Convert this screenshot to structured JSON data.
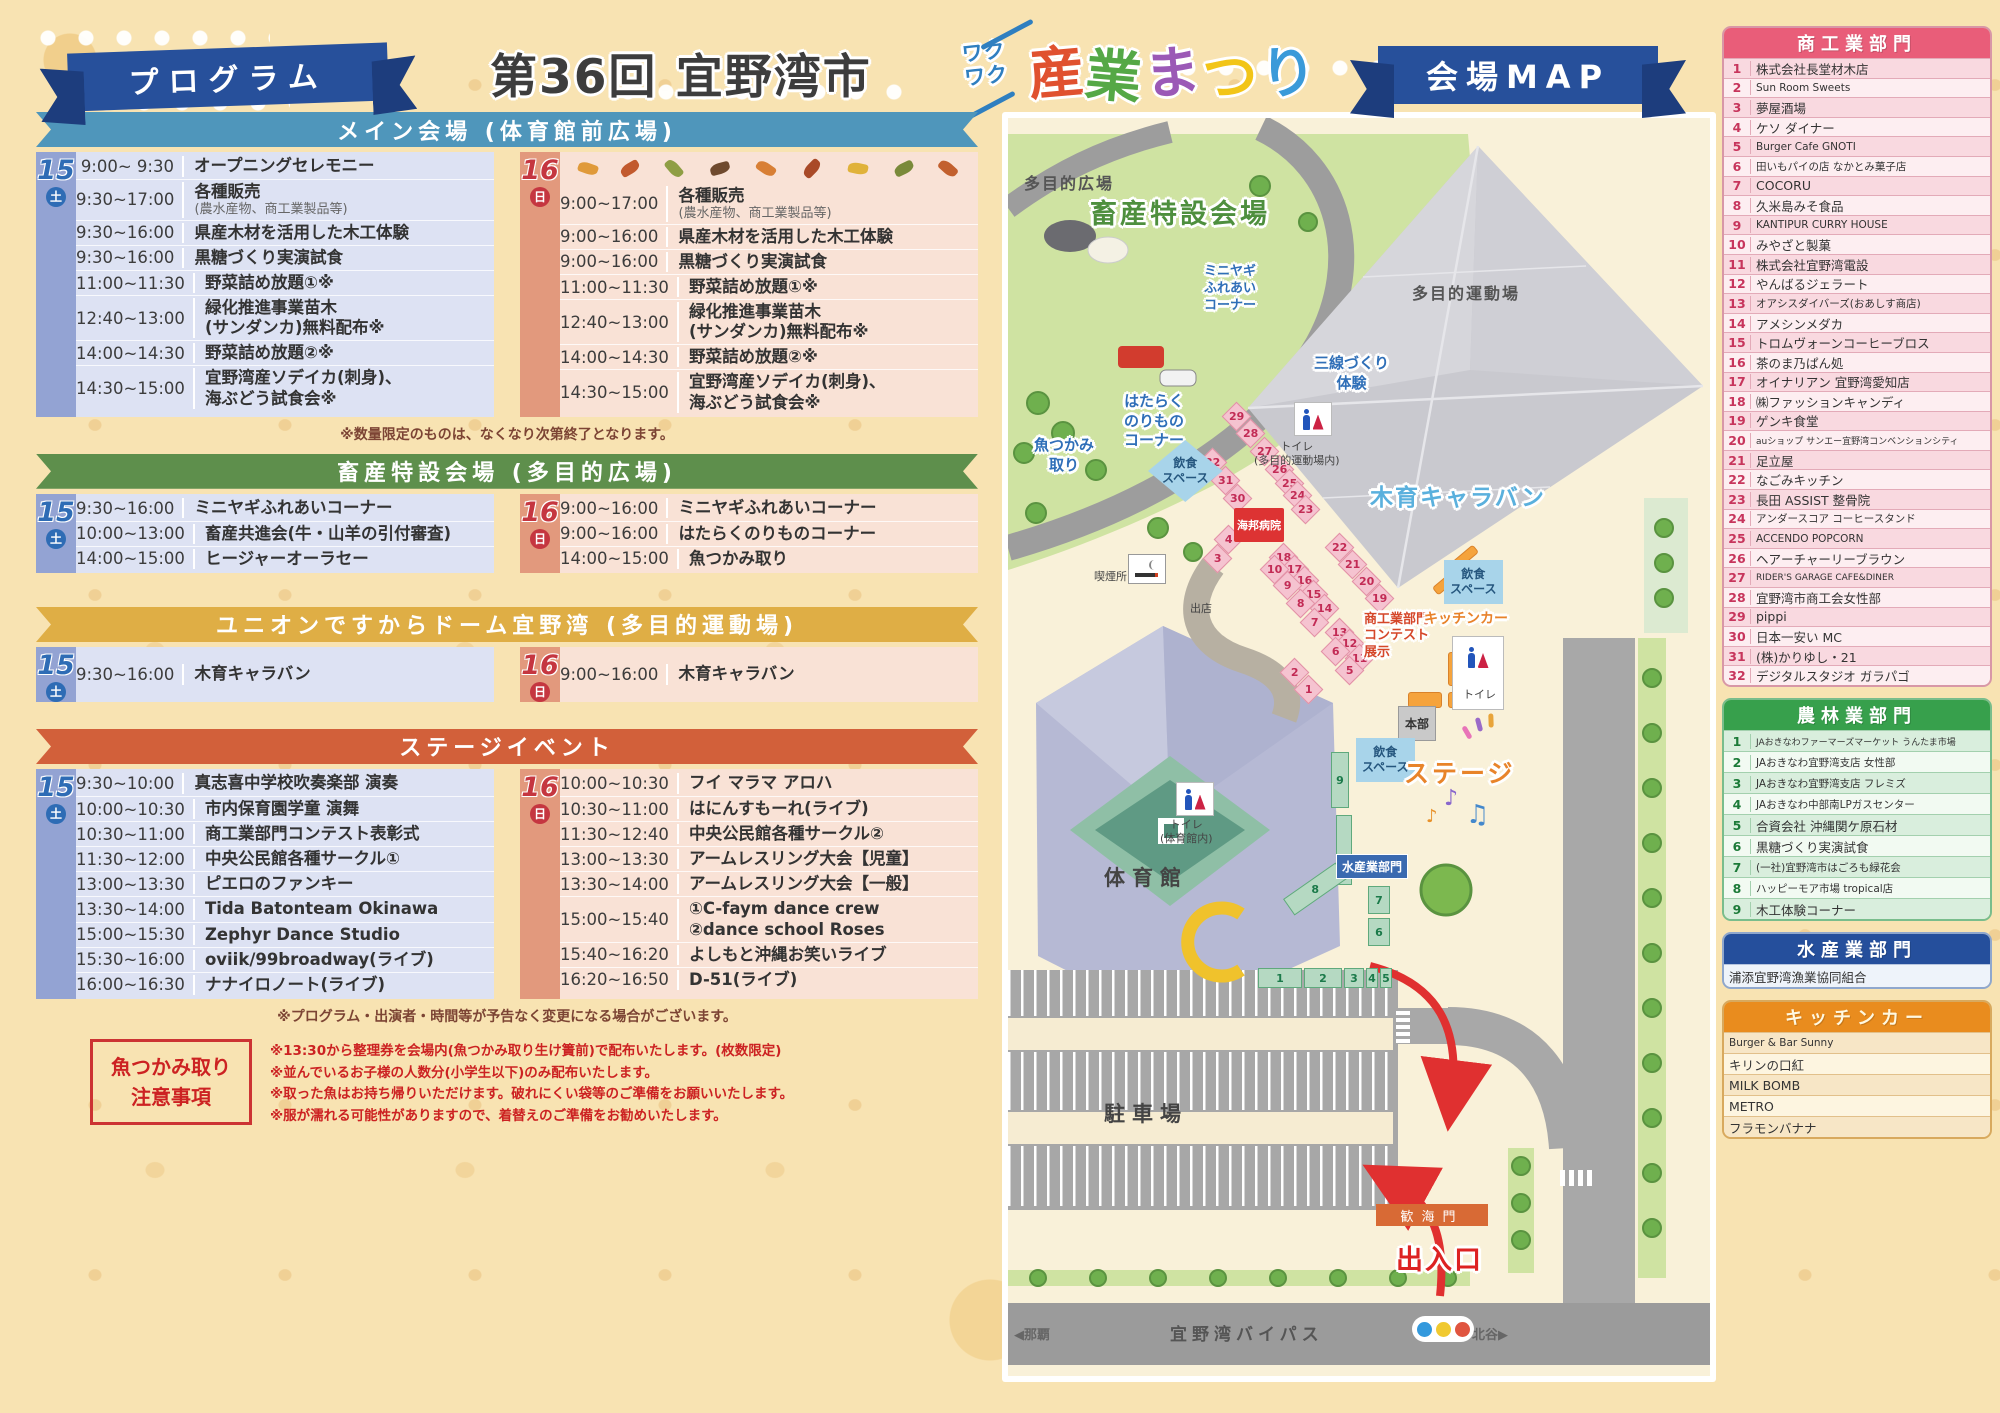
{
  "header": {
    "program_ribbon": "プログラム",
    "title_prefix": "第36回 宜野湾市",
    "title_waku": "ワクワク",
    "title_main": "産業まつり",
    "title_main_colors": [
      "#e0512f",
      "#55a846",
      "#9b59b6",
      "#f2c518",
      "#3a9ad9"
    ],
    "map_ribbon": "会場MAP"
  },
  "sections": [
    {
      "id": "main",
      "title": "メイン会場 (体育館前広場)",
      "accent": "#4f96bb",
      "sat": {
        "day": "15",
        "dow": "土",
        "rows": [
          {
            "time": "9:00~ 9:30",
            "event": "オープニングセレモニー"
          },
          {
            "time": "9:30~17:00",
            "event": "各種販売",
            "sub": "(農水産物、商工業製品等)"
          },
          {
            "time": "9:30~16:00",
            "event": "県産木材を活用した木工体験"
          },
          {
            "time": "9:30~16:00",
            "event": "黒糖づくり実演試食"
          },
          {
            "time": "11:00~11:30",
            "event": "野菜詰め放題①※"
          },
          {
            "time": "12:40~13:00",
            "event": "緑化推進事業苗木\n(サンダンカ)無料配布※"
          },
          {
            "time": "14:00~14:30",
            "event": "野菜詰め放題②※"
          },
          {
            "time": "14:30~15:00",
            "event": "宜野湾産ソデイカ(刺身)、\n海ぶどう試食会※"
          }
        ]
      },
      "sun": {
        "day": "16",
        "dow": "日",
        "leaves": true,
        "rows": [
          {
            "time": "9:00~17:00",
            "event": "各種販売",
            "sub": "(農水産物、商工業製品等)"
          },
          {
            "time": "9:00~16:00",
            "event": "県産木材を活用した木工体験"
          },
          {
            "time": "9:00~16:00",
            "event": "黒糖づくり実演試食"
          },
          {
            "time": "11:00~11:30",
            "event": "野菜詰め放題①※"
          },
          {
            "time": "12:40~13:00",
            "event": "緑化推進事業苗木\n(サンダンカ)無料配布※"
          },
          {
            "time": "14:00~14:30",
            "event": "野菜詰め放題②※"
          },
          {
            "time": "14:30~15:00",
            "event": "宜野湾産ソデイカ(刺身)、\n海ぶどう試食会※"
          }
        ]
      },
      "note_after": "※数量限定のものは、なくなり次第終了となります。"
    },
    {
      "id": "chiku",
      "title": "畜産特設会場 (多目的広場)",
      "accent": "#5e8f4c",
      "sat": {
        "day": "15",
        "dow": "土",
        "rows": [
          {
            "time": "9:30~16:00",
            "event": "ミニヤギふれあいコーナー"
          },
          {
            "time": "10:00~13:00",
            "event": "畜産共進会(牛・山羊の引付審査)"
          },
          {
            "time": "14:00~15:00",
            "event": "ヒージャーオーラセー"
          }
        ]
      },
      "sun": {
        "day": "16",
        "dow": "日",
        "rows": [
          {
            "time": "9:00~16:00",
            "event": "ミニヤギふれあいコーナー"
          },
          {
            "time": "9:00~16:00",
            "event": "はたらくのりものコーナー"
          },
          {
            "time": "14:00~15:00",
            "event": "魚つかみ取り"
          }
        ]
      }
    },
    {
      "id": "union",
      "title": "ユニオンですからドーム宜野湾 (多目的運動場)",
      "accent": "#dfae45",
      "sat": {
        "day": "15",
        "dow": "土",
        "rows": [
          {
            "time": "9:30~16:00",
            "event": "木育キャラバン"
          }
        ]
      },
      "sun": {
        "day": "16",
        "dow": "日",
        "rows": [
          {
            "time": "9:00~16:00",
            "event": "木育キャラバン"
          }
        ]
      }
    },
    {
      "id": "stage",
      "title": "ステージイベント",
      "accent": "#d2603a",
      "sat": {
        "day": "15",
        "dow": "土",
        "rows": [
          {
            "time": "9:30~10:00",
            "event": "真志喜中学校吹奏楽部 演奏"
          },
          {
            "time": "10:00~10:30",
            "event": "市内保育園学童 演舞"
          },
          {
            "time": "10:30~11:00",
            "event": "商工業部門コンテスト表彰式"
          },
          {
            "time": "11:30~12:00",
            "event": "中央公民館各種サークル①"
          },
          {
            "time": "13:00~13:30",
            "event": "ピエロのファンキー"
          },
          {
            "time": "13:30~14:00",
            "event": "Tida Batonteam Okinawa"
          },
          {
            "time": "15:00~15:30",
            "event": "Zephyr Dance Studio"
          },
          {
            "time": "15:30~16:00",
            "event": "oviik/99broadway(ライブ)"
          },
          {
            "time": "16:00~16:30",
            "event": "ナナイロノート(ライブ)"
          }
        ]
      },
      "sun": {
        "day": "16",
        "dow": "日",
        "rows": [
          {
            "time": "10:00~10:30",
            "event": "フイ マラマ アロハ"
          },
          {
            "time": "10:30~11:00",
            "event": "はにんすもーれ(ライブ)"
          },
          {
            "time": "11:30~12:40",
            "event": "中央公民館各種サークル②"
          },
          {
            "time": "13:00~13:30",
            "event": "アームレスリング大会【児童】"
          },
          {
            "time": "13:30~14:00",
            "event": "アームレスリング大会【一般】"
          },
          {
            "time": "15:00~15:40",
            "event": "①C-faym dance crew\n②dance school Roses"
          },
          {
            "time": "15:40~16:20",
            "event": "よしもと沖縄お笑いライブ"
          },
          {
            "time": "16:20~16:50",
            "event": "D-51(ライブ)"
          }
        ]
      }
    }
  ],
  "notes": {
    "program_change": "※プログラム・出演者・時間等が予告なく変更になる場合がございます。",
    "fish_title": "魚つかみ取り\n注意事項",
    "fish_notes": [
      "※13:30から整理券を会場内(魚つかみ取り生け簀前)で配布いたします。(枚数限定)",
      "※並んでいるお子様の人数分(小学生以下)のみ配布いたします。",
      "※取った魚はお持ち帰りいただけます。破れにくい袋等のご準備をお願いいたします。",
      "※服が濡れる可能性がありますので、着替えのご準備をお勧めいたします。"
    ]
  },
  "sidebar": {
    "groups": [
      {
        "key": "shoko",
        "title": "商工業部門",
        "cls": "g-pink",
        "numbered": true,
        "row_h": 19.6,
        "items": [
          "株式会社長堂材木店",
          "Sun Room Sweets",
          "夢屋酒場",
          "ケソ ダイナー",
          "Burger Cafe GNOTI",
          "田いもパイの店 なかとみ菓子店",
          "COCORU",
          "久米島みそ食品",
          "KANTIPUR CURRY HOUSE",
          "みやざと製菓",
          "株式会社宜野湾電設",
          "やんばるジェラート",
          "オアシスダイバーズ(おあしす商店)",
          "アメシンメダカ",
          "トロムヴォーンコーヒーブロス",
          "茶のま乃ぱん処",
          "オイナリアン 宜野湾愛知店",
          "㈱ファッションキャンディ",
          "ゲンキ食堂",
          "auショップ サンエー宜野湾コンベンションシティ",
          "足立屋",
          "なごみキッチン",
          "長田 ASSIST 整骨院",
          "アンダースコア コーヒースタンド",
          "ACCENDO POPCORN",
          "ヘアーチャーリーブラウン",
          "RIDER'S GARAGE CAFE&DINER",
          "宜野湾市商工会女性部",
          "pippi",
          "日本一安い MC",
          "(株)かりゆし・21",
          "デジタルスタジオ ガラパゴ"
        ]
      },
      {
        "key": "norin",
        "title": "農林業部門",
        "cls": "g-green",
        "numbered": true,
        "row_h": 21,
        "items": [
          "JAおきなわファーマーズマーケット うんたま市場",
          "JAおきなわ宜野湾支店 女性部",
          "JAおきなわ宜野湾支店 フレミズ",
          "JAおきなわ中部南LPガスセンター",
          "合資会社 沖縄関ケ原石材",
          "黒糖づくり実演試食",
          "(一社)宜野湾市はごろも緑花会",
          "ハッピーモア市場 tropical店",
          "木工体験コーナー"
        ]
      },
      {
        "key": "suisan",
        "title": "水産業部門",
        "cls": "g-blue",
        "numbered": false,
        "row_h": 23,
        "items": [
          "浦添宜野湾漁業協同組合"
        ]
      },
      {
        "key": "kitchen",
        "title": "キッチンカー",
        "cls": "g-orange",
        "numbered": false,
        "row_h": 21,
        "items": [
          "Burger & Bar Sunny",
          "キリンの口紅",
          "MILK BOMB",
          "METRO",
          "フラモンバナナ"
        ]
      }
    ]
  },
  "map": {
    "labels": [
      {
        "t": "多目的広場",
        "cls": "area",
        "x": 16,
        "y": 52
      },
      {
        "t": "畜産特設会場",
        "cls": "gtitle ol-w",
        "x": 82,
        "y": 74
      },
      {
        "t": "ミニヤギ\nふれあい\nコーナー",
        "cls": "blue-s ctr ol-w",
        "x": 196,
        "y": 146
      },
      {
        "t": "多目的運動場",
        "cls": "area",
        "x": 404,
        "y": 162
      },
      {
        "t": "三線づくり\n体験",
        "cls": "blue-m ctr ol-w",
        "x": 306,
        "y": 236
      },
      {
        "t": "はたらく\nのりもの\nコーナー",
        "cls": "blue-m ctr ol-w",
        "x": 116,
        "y": 274
      },
      {
        "t": "魚つかみ\n取り",
        "cls": "blue-m ctr ol-w",
        "x": 26,
        "y": 318
      },
      {
        "t": "トイレ\n(多目的運動場内)",
        "cls": "small-dark ctr",
        "x": 246,
        "y": 322
      },
      {
        "t": "木育キャラバン",
        "cls": "ltblue ol-w",
        "x": 362,
        "y": 360
      },
      {
        "t": "飲食\nスペース",
        "cls": "eat eat-d",
        "x": 140,
        "y": 322
      },
      {
        "t": "海邦病院",
        "cls": "hospital",
        "x": 226,
        "y": 390
      },
      {
        "t": "喫煙所",
        "cls": "small-dark",
        "x": 86,
        "y": 452
      },
      {
        "t": "出店",
        "cls": "small-dark",
        "x": 182,
        "y": 484
      },
      {
        "t": "商工業部門\nコンテスト\n展示",
        "cls": "red-s ol-w",
        "x": 356,
        "y": 494
      },
      {
        "t": "キッチンカー",
        "cls": "orange-s ol-w",
        "x": 416,
        "y": 490
      },
      {
        "t": "飲食\nスペース",
        "cls": "eat",
        "x": 436,
        "y": 442
      },
      {
        "t": "トイレ",
        "cls": "small-dark",
        "x": 455,
        "y": 570
      },
      {
        "t": "本部",
        "cls": "honbu",
        "x": 390,
        "y": 588
      },
      {
        "t": "飲食\nスペース",
        "cls": "eat",
        "x": 348,
        "y": 620
      },
      {
        "t": "ステージ",
        "cls": "stage ol-w",
        "x": 396,
        "y": 636
      },
      {
        "t": "トイレ\n(体育館内)",
        "cls": "small-dark ctr",
        "x": 152,
        "y": 700
      },
      {
        "t": "体育館",
        "cls": "big-dark",
        "x": 96,
        "y": 744
      },
      {
        "t": "水産業部門",
        "cls": "suisan",
        "x": 328,
        "y": 736
      },
      {
        "t": "駐車場",
        "cls": "big-dark",
        "x": 96,
        "y": 980
      },
      {
        "t": "歓海門",
        "cls": "gate",
        "x": 368,
        "y": 1086
      },
      {
        "t": "出入口",
        "cls": "red-big ol-w",
        "x": 388,
        "y": 1120
      },
      {
        "t": "◀那覇",
        "cls": "road-s",
        "x": 6,
        "y": 1206
      },
      {
        "t": "宜野湾バイパス",
        "cls": "road",
        "x": 162,
        "y": 1202
      },
      {
        "t": "北谷▶",
        "cls": "road-s",
        "x": 464,
        "y": 1206
      }
    ],
    "booths_pink": [
      [
        "29",
        228,
        298
      ],
      [
        "28",
        242,
        315
      ],
      [
        "27",
        256,
        333
      ],
      [
        "26",
        271,
        351
      ],
      [
        "25",
        281,
        365
      ],
      [
        "24",
        289,
        377
      ],
      [
        "23",
        297,
        391
      ],
      [
        "32",
        204,
        344
      ],
      [
        "31",
        217,
        362
      ],
      [
        "30",
        229,
        380
      ],
      [
        "4",
        220,
        421
      ],
      [
        "3",
        209,
        440
      ],
      [
        "18",
        275,
        439
      ],
      [
        "17",
        286,
        451
      ],
      [
        "16",
        296,
        462
      ],
      [
        "15",
        305,
        476
      ],
      [
        "14",
        316,
        490
      ],
      [
        "10",
        266,
        451
      ],
      [
        "9",
        279,
        467
      ],
      [
        "8",
        292,
        485
      ],
      [
        "7",
        306,
        504
      ],
      [
        "22",
        331,
        429
      ],
      [
        "21",
        344,
        446
      ],
      [
        "20",
        358,
        463
      ],
      [
        "19",
        371,
        480
      ],
      [
        "13",
        331,
        514
      ],
      [
        "12",
        341,
        525
      ],
      [
        "11",
        351,
        540
      ],
      [
        "6",
        327,
        533
      ],
      [
        "5",
        341,
        552
      ],
      [
        "2",
        286,
        554
      ],
      [
        "1",
        300,
        571
      ]
    ],
    "booths_green": [
      [
        "9",
        332,
        662,
        18,
        56,
        0
      ],
      [
        "",
        336,
        732,
        16,
        70,
        0
      ],
      [
        "8",
        307,
        771,
        64,
        20,
        -35
      ],
      [
        "7",
        371,
        782,
        22,
        28,
        0
      ],
      [
        "6",
        371,
        814,
        22,
        28,
        0
      ],
      [
        "1",
        272,
        860,
        44,
        20,
        0
      ],
      [
        "2",
        315,
        860,
        38,
        20,
        0
      ],
      [
        "3",
        346,
        860,
        20,
        20,
        0
      ],
      [
        "4",
        364,
        860,
        12,
        20,
        0
      ],
      [
        "5",
        378,
        860,
        12,
        20,
        0
      ]
    ]
  }
}
